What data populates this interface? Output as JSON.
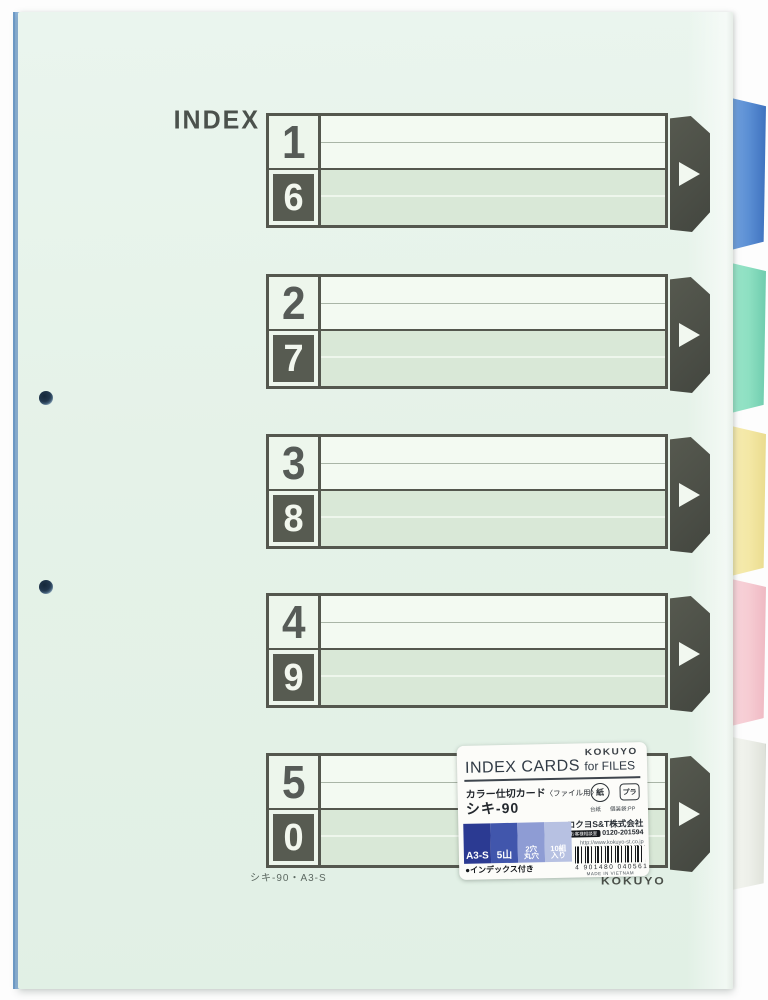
{
  "product": {
    "index_label": "INDEX",
    "blocks": [
      {
        "top": "1",
        "bottom": "6"
      },
      {
        "top": "2",
        "bottom": "7"
      },
      {
        "top": "3",
        "bottom": "8"
      },
      {
        "top": "4",
        "bottom": "9"
      },
      {
        "top": "5",
        "bottom": "0"
      }
    ],
    "bottom_code": "シキ-90・A3-S",
    "brand_print": "KOKUYO",
    "punch_holes": 2
  },
  "tabs": [
    {
      "name": "blue",
      "color": "#5b8fd4"
    },
    {
      "name": "green",
      "color": "#8ee0c2"
    },
    {
      "name": "yellow",
      "color": "#f4e8a6"
    },
    {
      "name": "pink",
      "color": "#f6ccd3"
    },
    {
      "name": "white",
      "color": "#eef0ea"
    }
  ],
  "label": {
    "brand": "KOKUYO",
    "title_en": "INDEX CARDS",
    "title_en2": "for FILES",
    "title_ja": "カラー仕切カード",
    "title_ja_note": "〈ファイル用〉",
    "model": "シキ-90",
    "recycle_paper_icon": "紙",
    "recycle_paper_caption": "台紙",
    "recycle_plastic_icon": "プラ",
    "recycle_plastic_caption": "個装袋:PP",
    "company": "コクヨS&T株式会社",
    "support": "お客様相談室",
    "phone": "0120-201594",
    "url": "http://www.kokuyo-st.co.jp",
    "specs": [
      {
        "line1": "A3-S",
        "line2": "",
        "color": "#2b3a92"
      },
      {
        "line1": "5山",
        "line2": "",
        "color": "#4156ac"
      },
      {
        "line1": "2穴",
        "line2": "丸穴",
        "color": "#8e9cd4"
      },
      {
        "line1": "10組",
        "line2": "入り",
        "color": "#b7c1e2"
      }
    ],
    "barcode_number": "4 901480 040561",
    "origin": "MADE IN VIETNAM",
    "feature_note": "●インデックス付き"
  },
  "colors": {
    "card": "#e5f2e8",
    "print_dark": "#54574e",
    "shaded_row": "#d9e8d7",
    "back_edge_blue": "#a9c9e8"
  }
}
